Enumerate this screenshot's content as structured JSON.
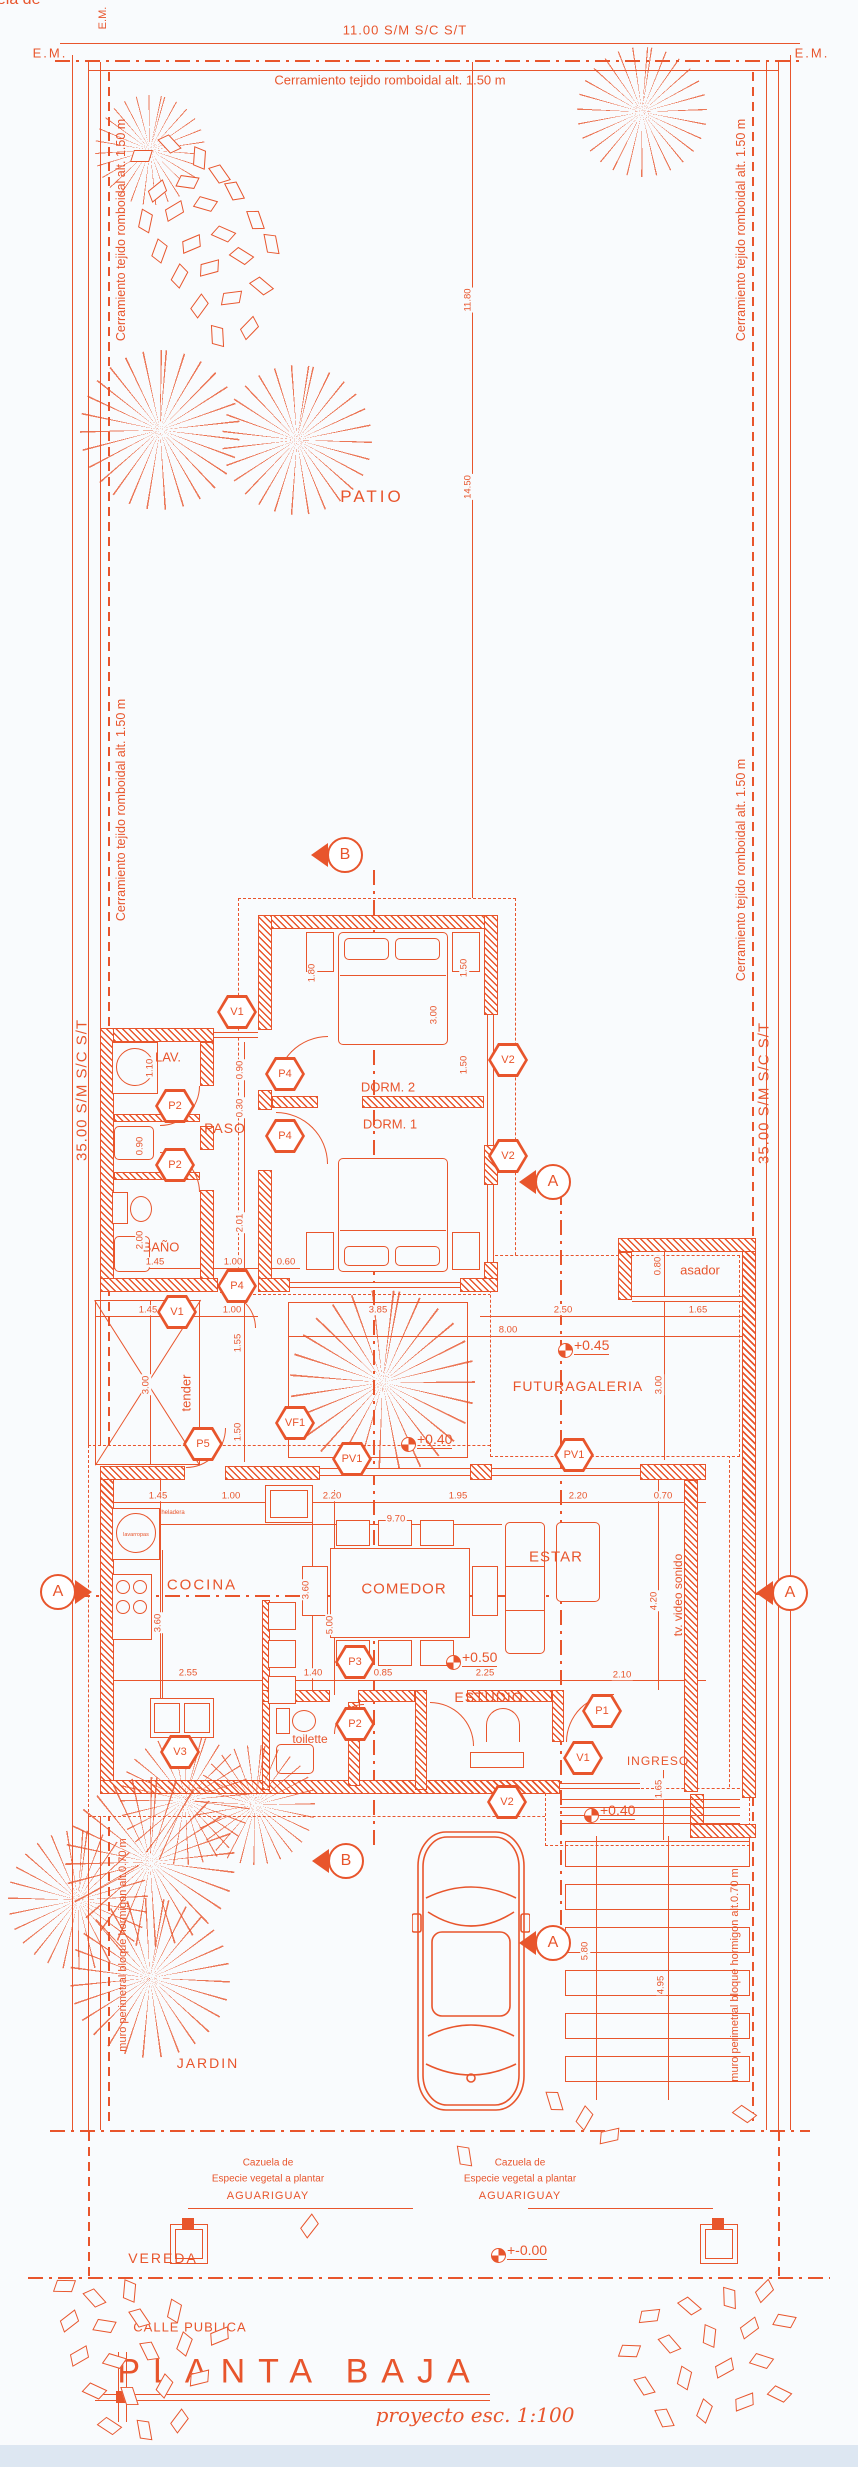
{
  "colors": {
    "ink": "#e8552c",
    "paper": "#f9fbfd",
    "stipple": "#e2a184"
  },
  "site": {
    "front_dim": "11.00 S/M S/C S/T",
    "side_dim": "35.00 S/M S/C S/T",
    "corner_mark": "E.M.",
    "fence_note": "Cerramiento tejido romboidal alt. 1.50 m",
    "perimeter_wall_note": "muro perimetral bloque hormigon alt.0.70 m",
    "sidewalk": "VEREDA",
    "street": "CALLE PUBLICA",
    "planting_note": {
      "l1": "Cazuela de",
      "l2": "Especie vegetal a plantar",
      "l3": "AGUARIGUAY"
    }
  },
  "rooms": {
    "patio": "PATIO",
    "lav": "LAV.",
    "paso": "PASO",
    "bano": "BAÑO",
    "dorm2": "DORM. 2",
    "dorm1": "DORM. 1",
    "asador": "asador",
    "futura_galeria": "FUTURAGALERIA",
    "tender": "tender",
    "cocina": "COCINA",
    "comedor": "COMEDOR",
    "estar": "ESTAR",
    "tv_note": "tv. video sonido",
    "estudio": "ESTUDIO",
    "toilette": "toilette",
    "ingreso": "INGRESO",
    "jardin": "JARDIN"
  },
  "appliances": {
    "fridge": "heladera",
    "washer": "lavarropas"
  },
  "title_block": {
    "title": "PLANTA BAJA",
    "scale_note": "proyecto esc. 1:100"
  },
  "levels": [
    {
      "x": 565,
      "y": 1350,
      "t": "+0.45"
    },
    {
      "x": 408,
      "y": 1444,
      "t": "+0.40"
    },
    {
      "x": 453,
      "y": 1662,
      "t": "+0.50"
    },
    {
      "x": 591,
      "y": 1815,
      "t": "+0.40"
    },
    {
      "x": 498,
      "y": 2255,
      "t": "+-0.00"
    }
  ],
  "tags": [
    {
      "x": 237,
      "y": 1012,
      "t": "V1"
    },
    {
      "x": 285,
      "y": 1074,
      "t": "P4"
    },
    {
      "x": 285,
      "y": 1136,
      "t": "P4"
    },
    {
      "x": 175,
      "y": 1106,
      "t": "P2"
    },
    {
      "x": 175,
      "y": 1165,
      "t": "P2"
    },
    {
      "x": 237,
      "y": 1286,
      "t": "P4"
    },
    {
      "x": 508,
      "y": 1060,
      "t": "V2"
    },
    {
      "x": 508,
      "y": 1156,
      "t": "V2"
    },
    {
      "x": 177,
      "y": 1312,
      "t": "V1"
    },
    {
      "x": 203,
      "y": 1444,
      "t": "P5"
    },
    {
      "x": 295,
      "y": 1423,
      "t": "VF1"
    },
    {
      "x": 352,
      "y": 1459,
      "t": "PV1"
    },
    {
      "x": 574,
      "y": 1455,
      "t": "PV1"
    },
    {
      "x": 355,
      "y": 1662,
      "t": "P3"
    },
    {
      "x": 355,
      "y": 1724,
      "t": "P2"
    },
    {
      "x": 180,
      "y": 1752,
      "t": "V3"
    },
    {
      "x": 602,
      "y": 1711,
      "t": "P1"
    },
    {
      "x": 583,
      "y": 1758,
      "t": "V1"
    },
    {
      "x": 507,
      "y": 1802,
      "t": "V2"
    }
  ],
  "markers": [
    {
      "x": 345,
      "y": 855,
      "l": "B",
      "d": "left"
    },
    {
      "x": 346,
      "y": 1861,
      "l": "B",
      "d": "left"
    },
    {
      "x": 58,
      "y": 1592,
      "l": "A",
      "d": "right"
    },
    {
      "x": 790,
      "y": 1593,
      "l": "A",
      "d": "left"
    },
    {
      "x": 553,
      "y": 1182,
      "l": "A",
      "d": "left"
    },
    {
      "x": 553,
      "y": 1943,
      "l": "A",
      "d": "left"
    }
  ],
  "dims": [
    {
      "x": 158,
      "y": 1496,
      "t": "1.45"
    },
    {
      "x": 231,
      "y": 1496,
      "t": "1.00"
    },
    {
      "x": 332,
      "y": 1496,
      "t": "2.20"
    },
    {
      "x": 458,
      "y": 1496,
      "t": "1.95"
    },
    {
      "x": 578,
      "y": 1496,
      "t": "2.20"
    },
    {
      "x": 663,
      "y": 1496,
      "t": "0.70"
    },
    {
      "x": 396,
      "y": 1519,
      "t": "9.70"
    },
    {
      "x": 188,
      "y": 1673,
      "t": "2.55"
    },
    {
      "x": 313,
      "y": 1673,
      "t": "1.40"
    },
    {
      "x": 383,
      "y": 1673,
      "t": "0.85"
    },
    {
      "x": 485,
      "y": 1673,
      "t": "2.25"
    },
    {
      "x": 622,
      "y": 1675,
      "t": "2.10"
    },
    {
      "x": 378,
      "y": 1310,
      "t": "3.85"
    },
    {
      "x": 563,
      "y": 1310,
      "t": "2.50"
    },
    {
      "x": 698,
      "y": 1310,
      "t": "1.65"
    },
    {
      "x": 508,
      "y": 1330,
      "t": "8.00"
    },
    {
      "x": 148,
      "y": 1310,
      "t": "1.45"
    },
    {
      "x": 232,
      "y": 1310,
      "t": "1.00"
    },
    {
      "x": 155,
      "y": 1262,
      "t": "1.45"
    },
    {
      "x": 233,
      "y": 1262,
      "t": "1.00"
    },
    {
      "x": 286,
      "y": 1262,
      "t": "0.60"
    },
    {
      "x": 468,
      "y": 487,
      "t": "14.50",
      "v": true
    },
    {
      "x": 468,
      "y": 300,
      "t": "11.80",
      "v": true
    },
    {
      "x": 312,
      "y": 973,
      "t": "1.80",
      "v": true
    },
    {
      "x": 434,
      "y": 1015,
      "t": "3.00",
      "v": true
    },
    {
      "x": 464,
      "y": 968,
      "t": "1.50",
      "v": true
    },
    {
      "x": 464,
      "y": 1065,
      "t": "1.50",
      "v": true
    },
    {
      "x": 240,
      "y": 1070,
      "t": "0.90",
      "v": true
    },
    {
      "x": 240,
      "y": 1108,
      "t": "0.30",
      "v": true
    },
    {
      "x": 240,
      "y": 1223,
      "t": "2.01",
      "v": true
    },
    {
      "x": 150,
      "y": 1068,
      "t": "1.10",
      "v": true
    },
    {
      "x": 140,
      "y": 1146,
      "t": "0.90",
      "v": true
    },
    {
      "x": 140,
      "y": 1240,
      "t": "2.00",
      "v": true
    },
    {
      "x": 146,
      "y": 1385,
      "t": "3.00",
      "v": true
    },
    {
      "x": 238,
      "y": 1343,
      "t": "1.55",
      "v": true
    },
    {
      "x": 238,
      "y": 1432,
      "t": "1.50",
      "v": true
    },
    {
      "x": 658,
      "y": 1266,
      "t": "0.80",
      "v": true
    },
    {
      "x": 659,
      "y": 1385,
      "t": "3.00",
      "v": true
    },
    {
      "x": 158,
      "y": 1623,
      "t": "3.60",
      "v": true
    },
    {
      "x": 306,
      "y": 1590,
      "t": "3.60",
      "v": true
    },
    {
      "x": 330,
      "y": 1625,
      "t": "5.00",
      "v": true
    },
    {
      "x": 654,
      "y": 1601,
      "t": "4.20",
      "v": true
    },
    {
      "x": 659,
      "y": 1789,
      "t": "1.65",
      "v": true
    },
    {
      "x": 585,
      "y": 1951,
      "t": "5.80",
      "v": true
    },
    {
      "x": 661,
      "y": 1985,
      "t": "4.95",
      "v": true
    }
  ]
}
